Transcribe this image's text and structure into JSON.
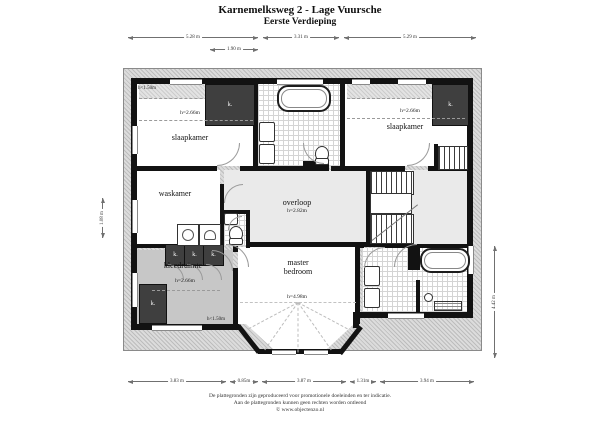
{
  "title": {
    "line1": "Karnemelksweg 2 - Lage Vuursche",
    "line2": "Eerste Verdieping"
  },
  "rooms": {
    "slaapkamer_left": {
      "label": "slaapkamer",
      "ceiling": "h=2.66m"
    },
    "slaapkamer_right": {
      "label": "slaapkamer",
      "ceiling": "h=2.66m"
    },
    "waskamer": {
      "label": "waskamer"
    },
    "overloop": {
      "label": "overloop",
      "ceiling": "h=2.82m"
    },
    "kleedruimte": {
      "label": "kleedruimte",
      "ceiling": "h=2.66m"
    },
    "master_bedroom": {
      "label_line1": "master",
      "label_line2": "bedroom",
      "ceiling": "h=4.98m"
    }
  },
  "closet_label": "k.",
  "annotations": {
    "low_ceiling": "h<1.50m"
  },
  "dimensions": {
    "top": [
      "5.28 m",
      "3.31 m",
      "5.29 m"
    ],
    "top_inner": "1.90 m",
    "bottom": [
      "3.83 m",
      "0.85m",
      "3.87 m",
      "1.31m",
      "3.94 m"
    ],
    "left": "1.08 m",
    "right": "4.42 m"
  },
  "footer": {
    "line1": "De plattegronden zijn geproduceerd voor promotionele doeleinden en ter indicatie.",
    "line2": "Aan de plattegronden kunnen geen rechten worden ontleend",
    "line3": "© www.objectenzo.nl"
  }
}
